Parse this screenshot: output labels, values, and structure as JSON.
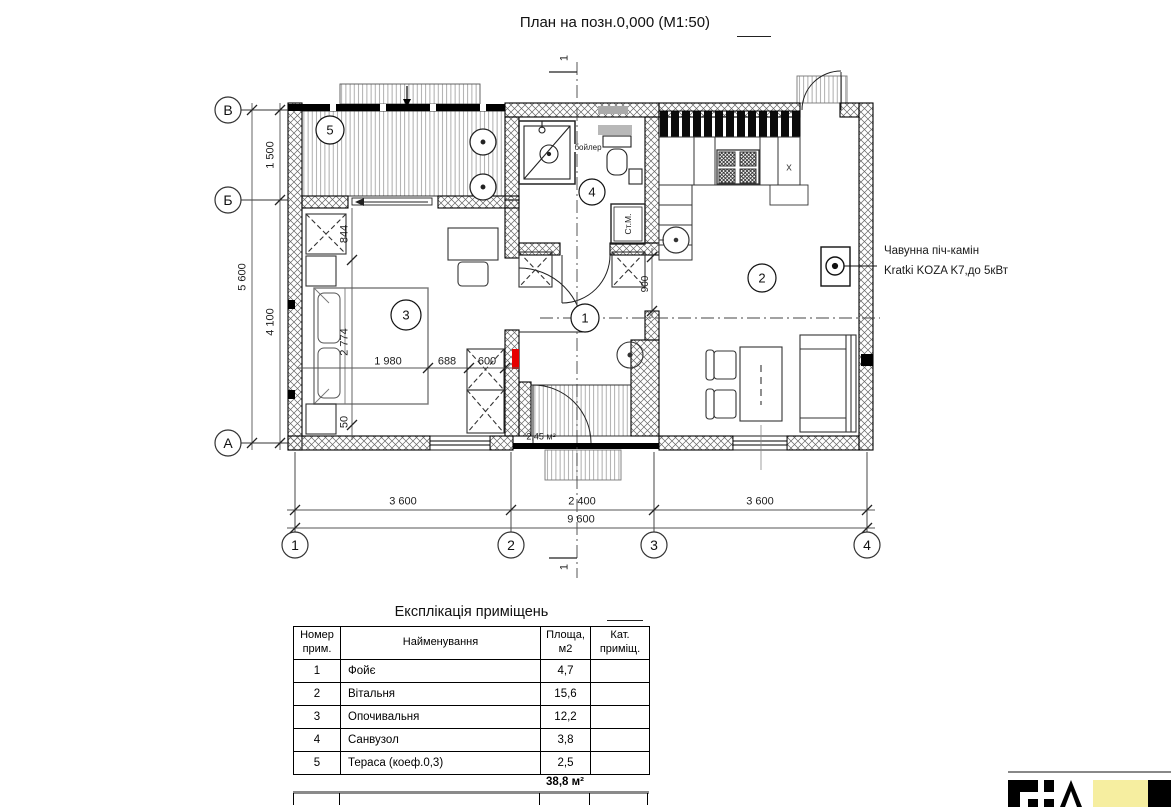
{
  "title": {
    "text": "План на позн.0,000 (М1:50)"
  },
  "grid": {
    "row_v": "В",
    "row_b": "Б",
    "row_a": "А",
    "col_1": "1",
    "col_2": "2",
    "col_3": "3",
    "col_4": "4"
  },
  "rooms": {
    "n1": "1",
    "n2": "2",
    "n3": "3",
    "n4": "4",
    "n5": "5"
  },
  "dims": {
    "left_1500": "1 500",
    "left_5600": "5 600",
    "left_4100": "4 100",
    "bot_1": "3 600",
    "bot_2": "2 400",
    "bot_3": "3 600",
    "bot_total": "9 600",
    "bed_844": "844",
    "bed_2774": "2 774",
    "bed_50": "50",
    "bed_1980": "1 980",
    "bed_688": "688",
    "bed_600": "600",
    "open_900": "900",
    "porch_area": "2,45 м²"
  },
  "labels": {
    "boiler": "бойлер",
    "washer": "Ст.М.",
    "sink": "x",
    "section": "1"
  },
  "annotation": {
    "line1": "Чавунна піч-камін",
    "line2": "Kratki KOZA K7,до 5кВт"
  },
  "table": {
    "title": "Експлікація приміщень",
    "headers": [
      "Номер прим.",
      "Найменування",
      "Площа, м2",
      "Кат. приміщ."
    ],
    "rows": [
      [
        "1",
        "Фойє",
        "4,7",
        ""
      ],
      [
        "2",
        "Вітальня",
        "15,6",
        ""
      ],
      [
        "3",
        "Опочивальня",
        "12,2",
        ""
      ],
      [
        "4",
        "Санвузол",
        "3,8",
        ""
      ],
      [
        "5",
        "Тераса (коеф.0,3)",
        "2,5",
        ""
      ]
    ],
    "total": "38,8 м²"
  },
  "colors": {
    "accent_red": "#e60000",
    "logo_yellow": "#f6eea0"
  }
}
